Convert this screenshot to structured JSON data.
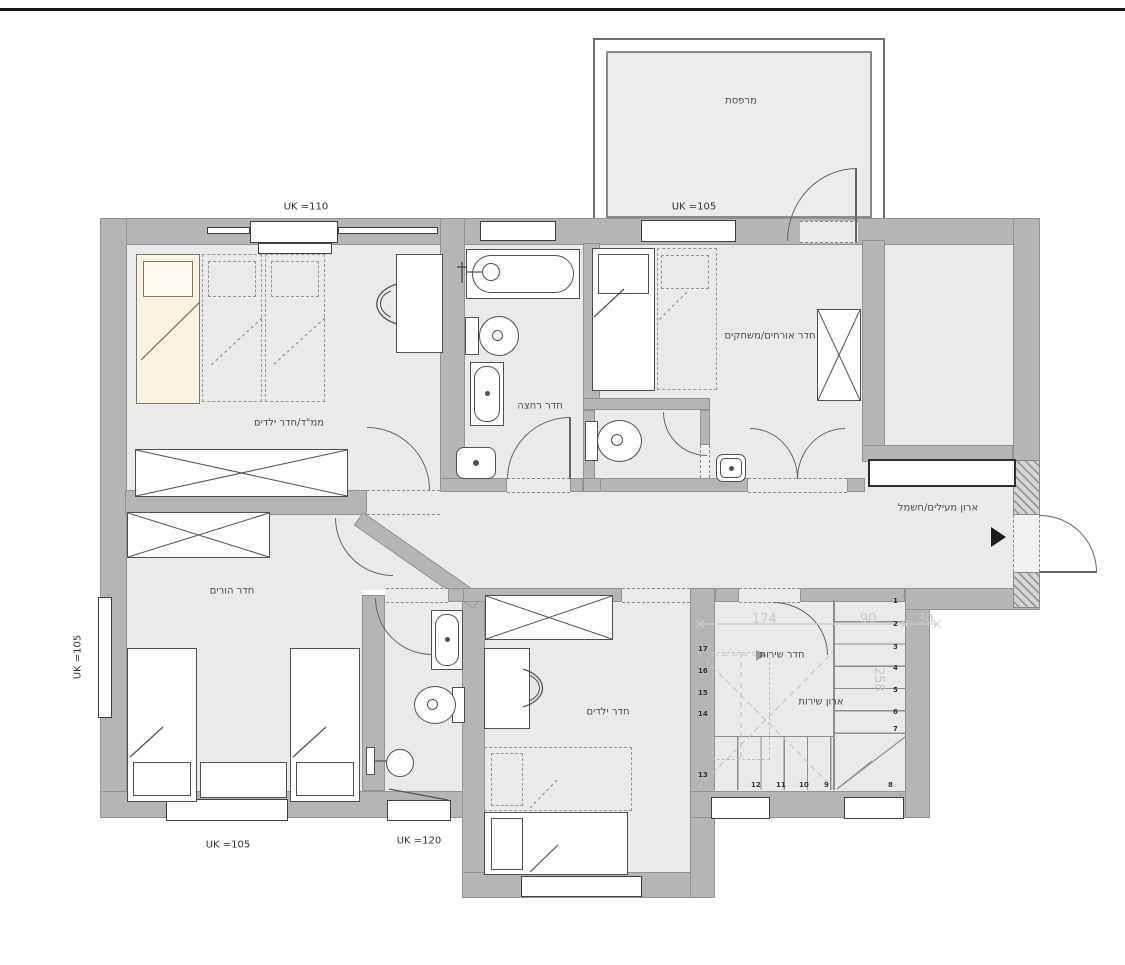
{
  "colors": {
    "wall_gray": "#b5b5b5",
    "room_fill": "#eaeaea",
    "bed_cream": "#fbf2df",
    "dim_text": "#c8c8c8",
    "outline": "#4f4f4f",
    "top_rule": "#151515"
  },
  "labels": {
    "balcony": "מרפסת",
    "sill_balcony": "UK =105",
    "sill_safe_room": "UK =110",
    "safe_room": "ממ\"ד/חדר ילדים",
    "bathroom": "חדר רחצה",
    "guest_room": "חדר אורחים/משחקים",
    "coat_closet": "ארון מעילים/חשמל",
    "parents_room": "חדר הורים",
    "kids_room": "חדר ילדים",
    "utility_room": "חדר שירות",
    "utility_closet": "ארון שירות",
    "sill_parents_left": "UK =105",
    "sill_parents_bottom": "UK =105",
    "sill_bath_bottom": "UK =120"
  },
  "dimensions": {
    "run_a": "174",
    "run_b": "90",
    "side": "30",
    "depth": "258"
  },
  "stairs": {
    "numbers": [
      "1",
      "2",
      "3",
      "4",
      "5",
      "6",
      "7",
      "8",
      "9",
      "10",
      "11",
      "12",
      "13",
      "14",
      "15",
      "16",
      "17"
    ]
  }
}
